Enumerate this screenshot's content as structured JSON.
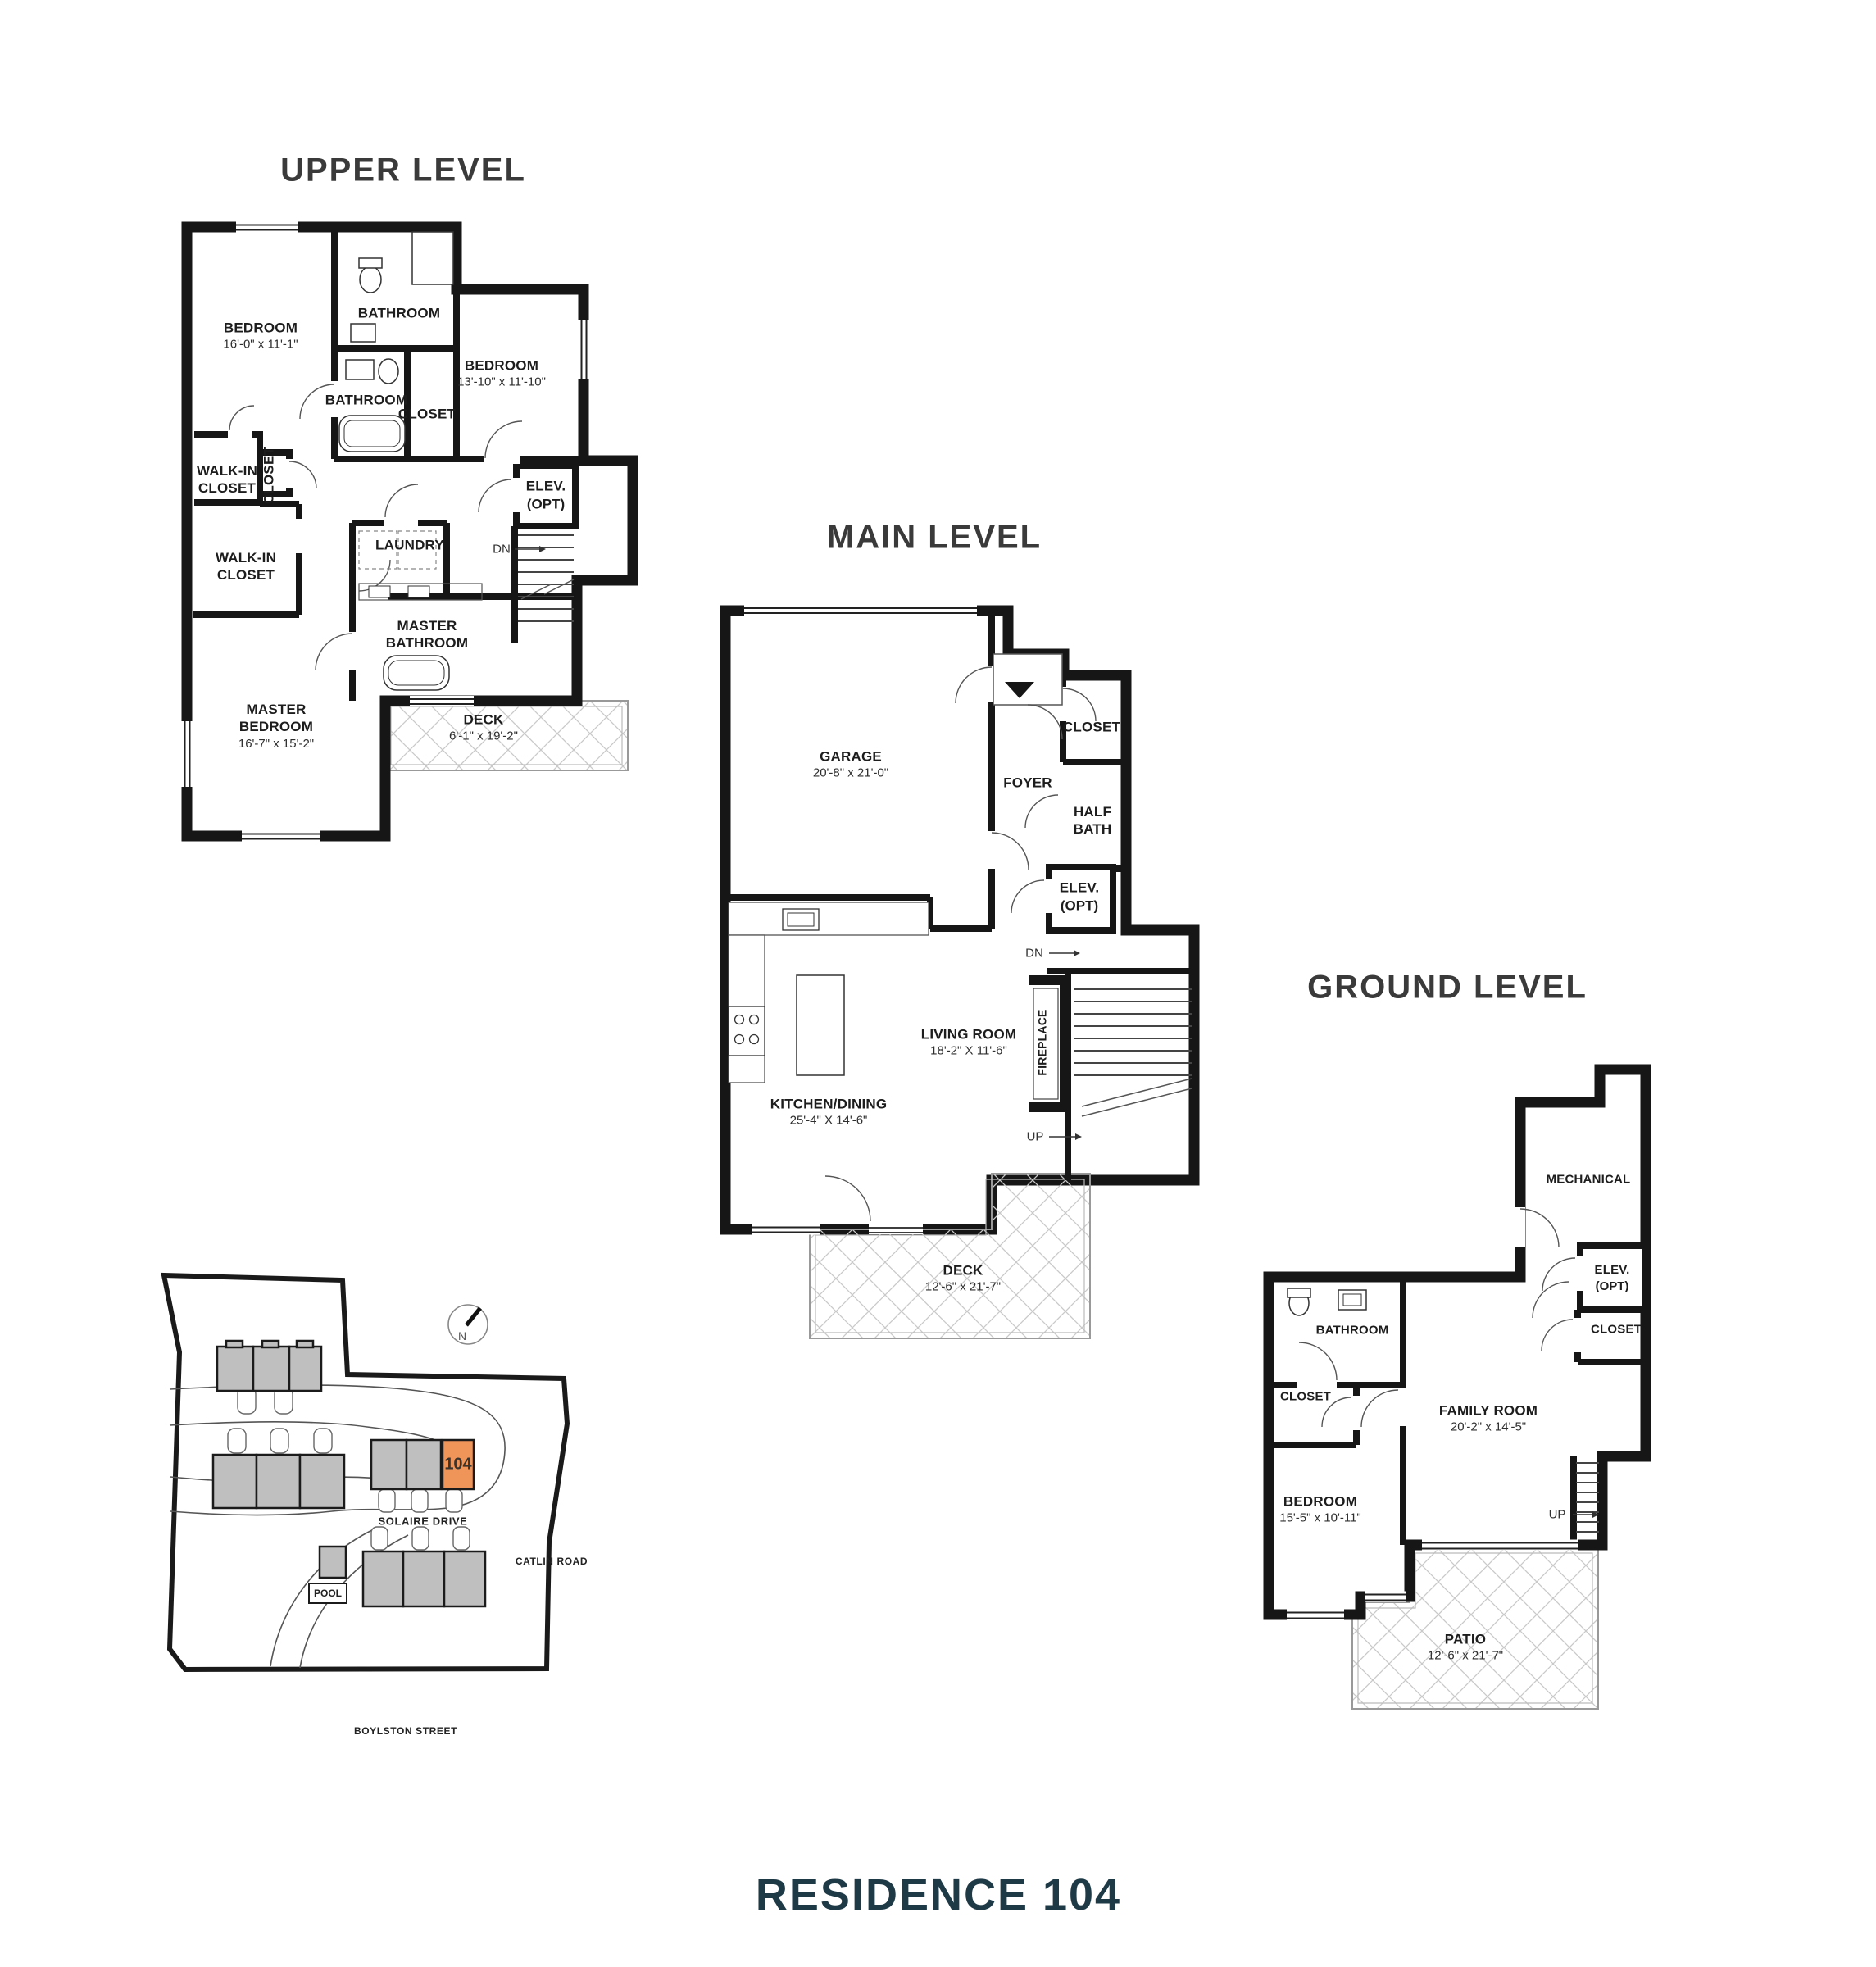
{
  "page": {
    "title": "RESIDENCE 104"
  },
  "colors": {
    "accent_orange": "#F0955A",
    "title_teal": "#1E3A46",
    "building_gray": "#BFBFBF",
    "wall_black": "#161616"
  },
  "levels": {
    "upper": {
      "title": "UPPER LEVEL",
      "rooms": {
        "bedroom": {
          "label": "BEDROOM",
          "sub": "16'-0\" x 11'-1\""
        },
        "bathroom_top": {
          "label": "BATHROOM"
        },
        "bathroom_mid": {
          "label": "BATHROOM"
        },
        "bedroom2": {
          "label": "BEDROOM",
          "sub": "13'-10\" x 11'-10\""
        },
        "bedroom2_closet": {
          "label": "CLOSET"
        },
        "walkin_closet_1": {
          "label": "WALK-IN CLOSET"
        },
        "hall_closet": {
          "label": "CLOSET"
        },
        "walkin_closet_2": {
          "label": "WALK-IN CLOSET"
        },
        "laundry": {
          "label": "LAUNDRY"
        },
        "elevator": {
          "label": "ELEV.",
          "sub": "(OPT)"
        },
        "stairs_dn": {
          "label": "DN"
        },
        "master_bathroom": {
          "label": "MASTER BATHROOM"
        },
        "master_bedroom": {
          "label": "MASTER BEDROOM",
          "sub": "16'-7\" x 15'-2\""
        },
        "deck": {
          "label": "DECK",
          "sub": "6'-1\" x 19'-2\""
        }
      }
    },
    "main": {
      "title": "MAIN LEVEL",
      "rooms": {
        "garage": {
          "label": "GARAGE",
          "sub": "20'-8\" x 21'-0\""
        },
        "closet": {
          "label": "CLOSET"
        },
        "foyer": {
          "label": "FOYER"
        },
        "half_bath": {
          "label": "HALF BATH"
        },
        "elevator": {
          "label": "ELEV.",
          "sub": "(OPT)"
        },
        "stairs_dn": {
          "label": "DN"
        },
        "living_room": {
          "label": "LIVING ROOM",
          "sub": "18'-2\" X 11'-6\""
        },
        "fireplace": {
          "label": "FIREPLACE"
        },
        "kitchen_dining": {
          "label": "KITCHEN/DINING",
          "sub": "25'-4\" X 14'-6\""
        },
        "stairs_up": {
          "label": "UP"
        },
        "deck": {
          "label": "DECK",
          "sub": "12'-6\" x 21'-7\""
        }
      }
    },
    "ground": {
      "title": "GROUND LEVEL",
      "rooms": {
        "mechanical": {
          "label": "MECHANICAL"
        },
        "elevator": {
          "label": "ELEV.",
          "sub": "(OPT)"
        },
        "closet_right": {
          "label": "CLOSET"
        },
        "bathroom": {
          "label": "BATHROOM"
        },
        "closet_left": {
          "label": "CLOSET"
        },
        "bedroom": {
          "label": "BEDROOM",
          "sub": "15'-5\" x 10'-11\""
        },
        "family_room": {
          "label": "FAMILY ROOM",
          "sub": "20'-2\" x 14'-5\""
        },
        "stairs_up": {
          "label": "UP"
        },
        "patio": {
          "label": "PATIO",
          "sub": "12'-6\" x 21'-7\""
        }
      }
    }
  },
  "site_plan": {
    "unit_number": "104",
    "pool_label": "POOL",
    "compass_n": "N",
    "streets": {
      "solaire": "SOLAIRE DRIVE",
      "catlin": "CATLIN ROAD",
      "boylston": "BOYLSTON STREET"
    }
  }
}
